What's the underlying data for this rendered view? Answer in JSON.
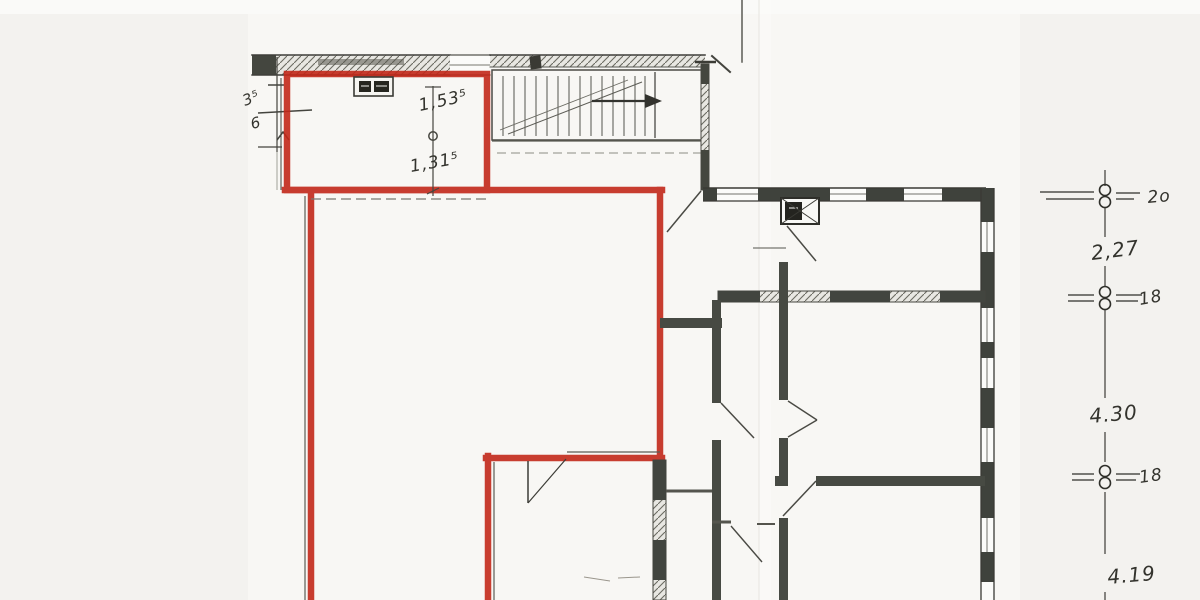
{
  "document": {
    "kind": "Scanned architectural floor plan with red marker outline",
    "colors": {
      "marker_red": "#c2281a",
      "pencil": "#41443e",
      "paper": "#f3f2ef"
    }
  },
  "red_room_annotations": {
    "upper": "1,53⁵",
    "lower": "1,31⁵"
  },
  "left_margin_dims": {
    "upper": "3⁵",
    "lower": "6"
  },
  "right_dimension_chain": {
    "labels": [
      {
        "text": "2o"
      },
      {
        "text": "2,27"
      },
      {
        "text": "18"
      },
      {
        "text": "4.30"
      },
      {
        "text": "18"
      },
      {
        "text": "4.19"
      }
    ]
  }
}
